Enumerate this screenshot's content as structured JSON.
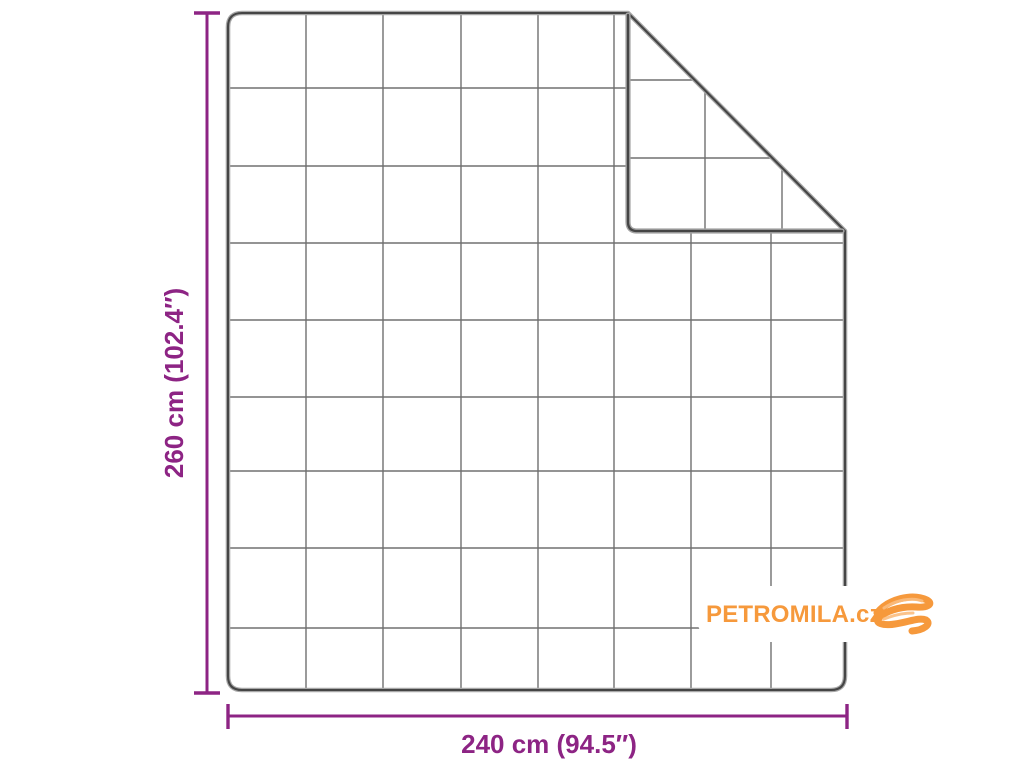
{
  "page": {
    "background": "#ffffff"
  },
  "blanket": {
    "outline_color": "#454545",
    "grid_color": "#585858",
    "grid_columns": 8,
    "grid_rows": 9,
    "folded_corner": "top-right"
  },
  "dimensions": {
    "color": "#8d2484",
    "height": {
      "label": "260 cm (102.4″)",
      "cm": 260,
      "inches": 102.4
    },
    "width": {
      "label": "240 cm (94.5″)",
      "cm": 240,
      "inches": 94.5
    }
  },
  "logo": {
    "text": "PETROMILA.cz",
    "color": "#f6993c",
    "icon": "scribble-icon"
  }
}
